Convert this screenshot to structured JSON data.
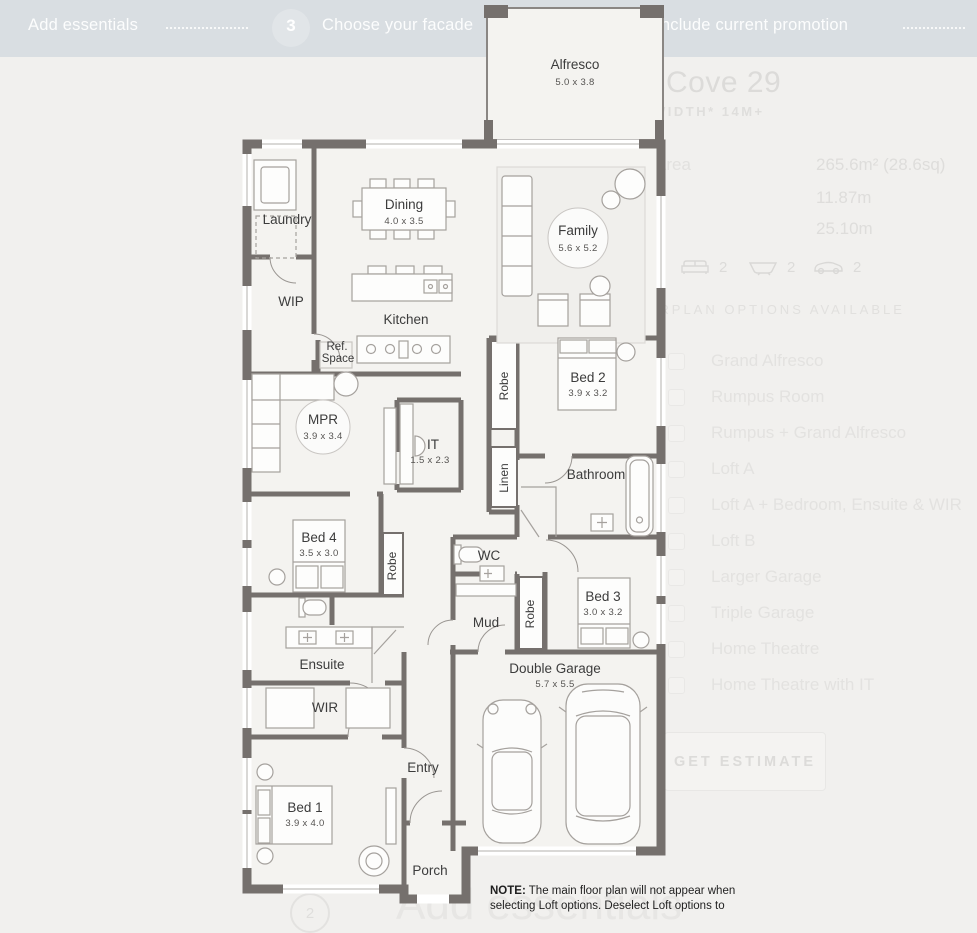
{
  "topbar": {
    "prev_step_label": "Add essentials",
    "step_number": "3",
    "step_label": "Choose your facade",
    "promo_label": "include current promotion"
  },
  "panel": {
    "title": "Cove 29",
    "subtitle": "WIDTH* 14M+",
    "specs": [
      {
        "label": "Area",
        "value": "265.6m² (28.6sq)"
      },
      {
        "label": "",
        "value": "11.87m"
      },
      {
        "label": "",
        "value": "25.10m"
      }
    ],
    "stats": [
      {
        "icon": "sofa-icon",
        "value": "2"
      },
      {
        "icon": "bath-icon",
        "value": "2"
      },
      {
        "icon": "car-icon",
        "value": "2"
      }
    ],
    "options_heading": "FLOORPLAN OPTIONS AVAILABLE",
    "options": [
      "Grand Alfresco",
      "Rumpus Room",
      "Rumpus + Grand Alfresco",
      "Loft A",
      "Loft A + Bedroom, Ensuite & WIR",
      "Loft B",
      "Larger Garage",
      "Triple Garage",
      "Home Theatre",
      "Home Theatre with IT"
    ],
    "estimate_button": "GET ESTIMATE"
  },
  "note": {
    "prefix": "NOTE:",
    "text": " The main floor plan will not appear when selecting Loft options. Deselect Loft options to"
  },
  "next_section": {
    "number": "2",
    "label": "Add essentials"
  },
  "floorplan": {
    "rooms": {
      "alfresco": {
        "name": "Alfresco",
        "dim": "5.0 x 3.8"
      },
      "laundry": {
        "name": "Laundry"
      },
      "wip": {
        "name": "WIP"
      },
      "dining": {
        "name": "Dining",
        "dim": "4.0 x 3.5"
      },
      "kitchen": {
        "name": "Kitchen"
      },
      "refspace": {
        "line1": "Ref.",
        "line2": "Space"
      },
      "family": {
        "name": "Family",
        "dim": "5.6 x 5.2"
      },
      "robe": {
        "name": "Robe"
      },
      "linen": {
        "name": "Linen"
      },
      "bed2": {
        "name": "Bed 2",
        "dim": "3.9 x 3.2"
      },
      "bathroom": {
        "name": "Bathroom"
      },
      "mpr": {
        "name": "MPR",
        "dim": "3.9 x 3.4"
      },
      "it": {
        "name": "IT",
        "dim": "1.5 x 2.3"
      },
      "bed4": {
        "name": "Bed 4",
        "dim": "3.5 x 3.0"
      },
      "wc": {
        "name": "WC"
      },
      "mud": {
        "name": "Mud"
      },
      "bed3": {
        "name": "Bed 3",
        "dim": "3.0 x 3.2"
      },
      "ensuite": {
        "name": "Ensuite"
      },
      "wir": {
        "name": "WIR"
      },
      "entry": {
        "name": "Entry"
      },
      "bed1": {
        "name": "Bed 1",
        "dim": "3.9 x 4.0"
      },
      "porch": {
        "name": "Porch"
      },
      "garage": {
        "name": "Double Garage",
        "dim": "5.7 x 5.5"
      }
    }
  }
}
